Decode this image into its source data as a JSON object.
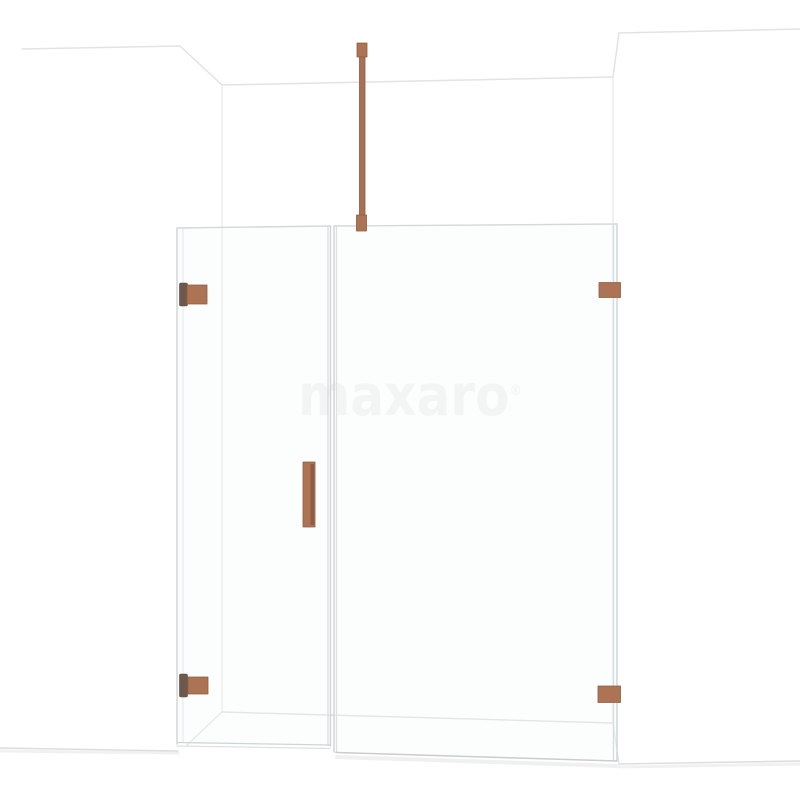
{
  "watermark": {
    "text": "maxaro",
    "registered_mark": "®",
    "color": "#f2f2f2"
  },
  "scene": {
    "alt": "White room corner with a frameless walk-in shower: hinged glass door with copper handle and two copper wall hinges on the left, fixed glass panel with two copper wall brackets and a copper ceiling support bar on the right"
  },
  "colors": {
    "copper": "#ad7355",
    "copper_dark": "#8d5c42",
    "copper_deep": "#6e584c",
    "copper_bar": "#a87056",
    "background": "#ffffff",
    "wall_line": "#e3e3e3",
    "floor_line": "#d9d9d9",
    "glass_edge": "#cfd4d6",
    "glass_edge_soft": "#e2e6e8"
  }
}
